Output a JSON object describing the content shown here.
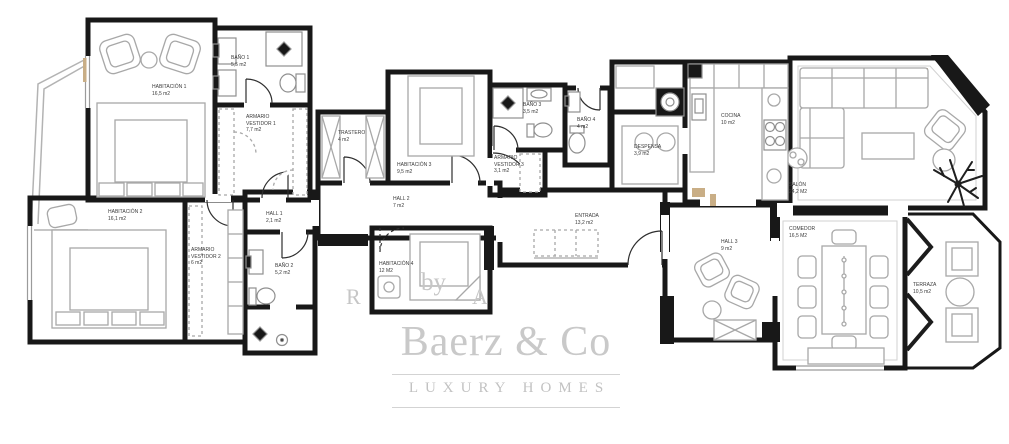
{
  "brand": {
    "name": "Baerz & Co",
    "tagline": "LUXURY HOMES",
    "watermark_fragments": {
      "left": "R",
      "mid": "by",
      "right": "A"
    }
  },
  "rooms": {
    "habitacion1": {
      "name": "HABITACIÓN 1",
      "area": "16,5 m2"
    },
    "bano1": {
      "name": "BAÑO 1",
      "area": "5,5 m2"
    },
    "armario_vestidor_1": {
      "name": "ARMARIO\nVESTIDOR 1",
      "area": "7,7 m2"
    },
    "trastero": {
      "name": "TRASTERO",
      "area": "4 m2"
    },
    "habitacion3": {
      "name": "HABITACIÓN 3",
      "area": "9,5 m2"
    },
    "hall2": {
      "name": "HALL 2",
      "area": "7 m2"
    },
    "bano3": {
      "name": "BAÑO 3",
      "area": "3,5 m2"
    },
    "bano4": {
      "name": "BAÑO 4",
      "area": "4 m2"
    },
    "armario_vestidor_3": {
      "name": "ARMARIO\nVESTIDOR 3",
      "area": "3,1 m2"
    },
    "despensa": {
      "name": "DESPENSA",
      "area": "3,9 m2"
    },
    "cocina": {
      "name": "COCINA",
      "area": "10 m2"
    },
    "salon": {
      "name": "SALÓN",
      "area": "24,2 M2"
    },
    "habitacion2": {
      "name": "HABITACIÓN 2",
      "area": "16,1 m2"
    },
    "armario_vestidor_2": {
      "name": "ARMARIO\nVESTIDOR 2",
      "area": "6 m2"
    },
    "hall1": {
      "name": "HALL 1",
      "area": "2,1 m2"
    },
    "bano2": {
      "name": "BAÑO 2",
      "area": "5,2 m2"
    },
    "habitacion4": {
      "name": "HABITACIÓN 4",
      "area": "12 M2"
    },
    "entrada": {
      "name": "ENTRADA",
      "area": "13,2 m2"
    },
    "hall3": {
      "name": "HALL 3",
      "area": "9 m2"
    },
    "comedor": {
      "name": "COMEDOR",
      "area": "16,5 M2"
    },
    "terraza": {
      "name": "TERRAZA",
      "area": "10,5 m2"
    }
  },
  "colors": {
    "wall": "#181818",
    "furniture": "#a8a8a8",
    "accent_sill": "#c9ae86",
    "logo_gray": "#c9c9c9"
  }
}
